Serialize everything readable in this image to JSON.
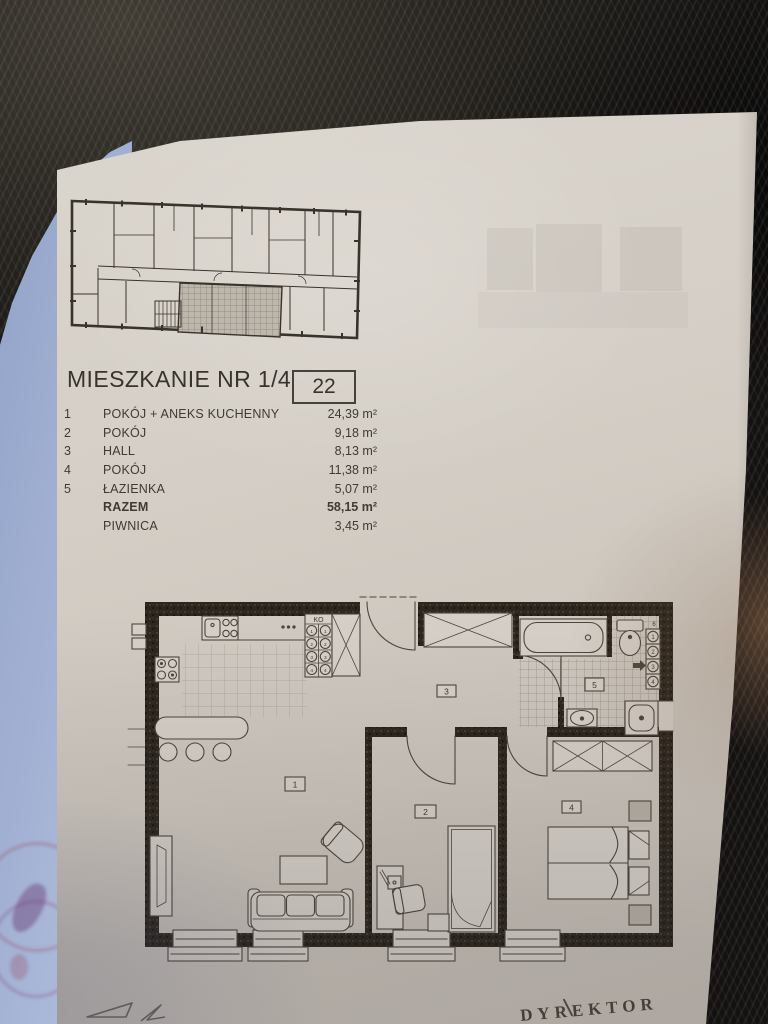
{
  "document": {
    "title": "MIESZKANIE NR 1/4",
    "unit_number": "22",
    "room_rows": [
      {
        "no": "1",
        "name": "POKÓJ + ANEKS KUCHENNY",
        "area": "24,39 m²"
      },
      {
        "no": "2",
        "name": "POKÓJ",
        "area": "9,18 m²"
      },
      {
        "no": "3",
        "name": "HALL",
        "area": "8,13 m²"
      },
      {
        "no": "4",
        "name": "POKÓJ",
        "area": "11,38 m²"
      },
      {
        "no": "5",
        "name": "ŁAZIENKA",
        "area": "5,07 m²"
      }
    ],
    "total_row": {
      "name": "RAZEM",
      "area": "58,15 m²"
    },
    "basement_row": {
      "name": "PIWNICA",
      "area": "3,45 m²"
    },
    "stamp_text": "DYREKTOR"
  },
  "floor_plan": {
    "labels": {
      "room1": "1",
      "room2": "2",
      "room3": "3",
      "room4": "4",
      "room5": "5",
      "shelf": "KO",
      "legend_top": "6"
    },
    "shelf_numbers": [
      "1",
      "2",
      "3",
      "4"
    ],
    "legend_numbers": [
      "1",
      "2",
      "3",
      "4"
    ]
  },
  "colors": {
    "paper": "#d5cfc7",
    "ink": "#4c453c",
    "wall": "#2c261e",
    "stamp_red": "#9e3450",
    "background": "#26231e",
    "page_stack_blue": "#b5c2e0"
  }
}
